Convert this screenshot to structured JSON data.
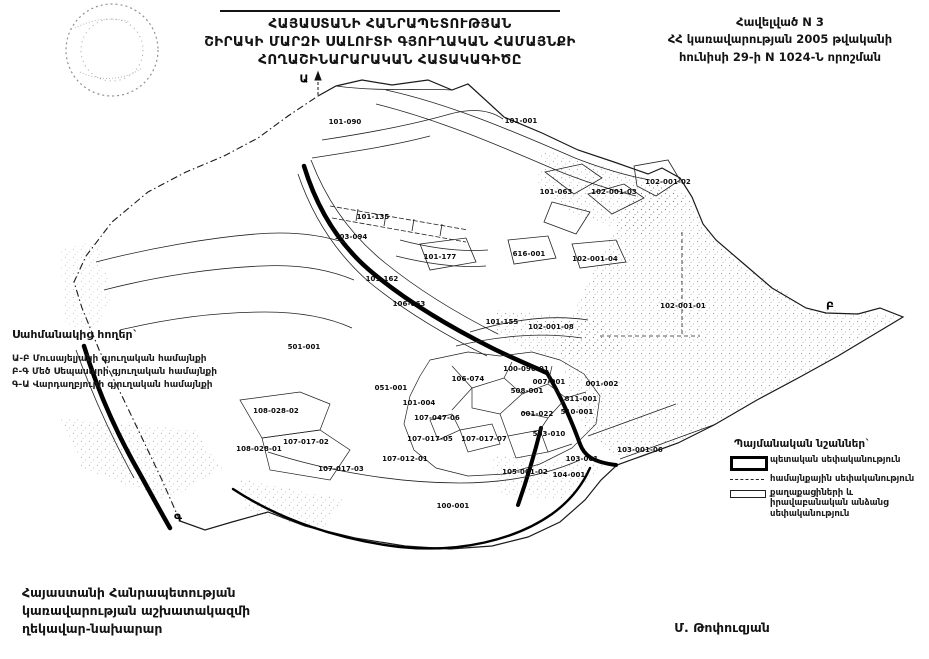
{
  "header": {
    "title_lines": [
      "ՀԱՅԱՍՏԱՆԻ ՀԱՆՐԱՊԵՏՈՒԹՅԱՆ",
      "ՇԻՐԱԿԻ ՄԱՐԶԻ ՍԱԼՈՒՏԻ ԳՅՈՒՂԱԿԱՆ ՀԱՄԱՅՆՔԻ",
      "ՀՈՂԱՇԻՆԱՐԱՐԱԿԱՆ ՀԱՏԱԿԱԳԻԾԸ"
    ],
    "annex_lines": [
      "Հավելված N 3",
      "ՀՀ կառավարության 2005 թվականի",
      "հունիսի 29-ի N 1024-Ն որոշման"
    ]
  },
  "adjacent_lands": {
    "title": "Սահմանակից հողեր`",
    "items": [
      "Ա-Բ Մուսայելյանի գյուղական համայնքի",
      "Բ-Գ Մեծ Սեպասարի գյուղական համայնքի",
      "Գ-Ա Վարդաղբյուրի գյուղական համայնքի"
    ]
  },
  "legend": {
    "title": "Պայմանական նշաններ`",
    "items": [
      {
        "symbol": "thick-border-rectangle",
        "label": "պետական սեփականություն"
      },
      {
        "symbol": "thin-dashed-line",
        "label": "համայնքային սեփականություն"
      },
      {
        "symbol": "double-line-rectangle",
        "label": "քաղաքացիների և իրավաբանական անձանց սեփականություն"
      }
    ]
  },
  "footer": {
    "left_lines": [
      "Հայաստանի Հանրապետության",
      "կառավարության աշխատակազմի",
      "ղեկավար-նախարար"
    ],
    "signature": "Մ. Թոփուզյան"
  },
  "map": {
    "boundary_points": [
      {
        "label": "Ա",
        "x": 304,
        "y": 79
      },
      {
        "label": "Բ",
        "x": 830,
        "y": 306
      },
      {
        "label": "Գ",
        "x": 178,
        "y": 518
      }
    ],
    "parcels": [
      {
        "id": "101-090",
        "x": 345,
        "y": 122
      },
      {
        "id": "101-001",
        "x": 521,
        "y": 121
      },
      {
        "id": "101-063",
        "x": 556,
        "y": 192
      },
      {
        "id": "102-001-03",
        "x": 614,
        "y": 192
      },
      {
        "id": "102-001-02",
        "x": 668,
        "y": 182
      },
      {
        "id": "616-001",
        "x": 529,
        "y": 254
      },
      {
        "id": "102-001-04",
        "x": 595,
        "y": 259
      },
      {
        "id": "102-001-01",
        "x": 683,
        "y": 306
      },
      {
        "id": "101-135",
        "x": 373,
        "y": 217
      },
      {
        "id": "103-094",
        "x": 351,
        "y": 237
      },
      {
        "id": "101-177",
        "x": 440,
        "y": 257
      },
      {
        "id": "101-162",
        "x": 382,
        "y": 279
      },
      {
        "id": "106-063",
        "x": 409,
        "y": 304
      },
      {
        "id": "101-155",
        "x": 502,
        "y": 322
      },
      {
        "id": "102-001-08",
        "x": 551,
        "y": 327
      },
      {
        "id": "501-001",
        "x": 304,
        "y": 347
      },
      {
        "id": "100-090-01",
        "x": 526,
        "y": 369
      },
      {
        "id": "106-074",
        "x": 468,
        "y": 379
      },
      {
        "id": "007-001",
        "x": 549,
        "y": 382
      },
      {
        "id": "001-002",
        "x": 602,
        "y": 384
      },
      {
        "id": "051-001",
        "x": 391,
        "y": 388
      },
      {
        "id": "508-001",
        "x": 527,
        "y": 391
      },
      {
        "id": "811-001",
        "x": 581,
        "y": 399
      },
      {
        "id": "101-004",
        "x": 419,
        "y": 403
      },
      {
        "id": "108-028-02",
        "x": 276,
        "y": 411
      },
      {
        "id": "001-022",
        "x": 537,
        "y": 414
      },
      {
        "id": "510-001",
        "x": 577,
        "y": 412
      },
      {
        "id": "107-047-06",
        "x": 437,
        "y": 418
      },
      {
        "id": "503-010",
        "x": 549,
        "y": 434
      },
      {
        "id": "107-017-05",
        "x": 430,
        "y": 439
      },
      {
        "id": "107-017-07",
        "x": 484,
        "y": 439
      },
      {
        "id": "107-017-02",
        "x": 306,
        "y": 442
      },
      {
        "id": "108-028-01",
        "x": 259,
        "y": 449
      },
      {
        "id": "103-001-06",
        "x": 640,
        "y": 450
      },
      {
        "id": "103-001",
        "x": 582,
        "y": 459
      },
      {
        "id": "107-012-01",
        "x": 405,
        "y": 459
      },
      {
        "id": "107-017-03",
        "x": 341,
        "y": 469
      },
      {
        "id": "105-001-02",
        "x": 525,
        "y": 472
      },
      {
        "id": "104-001",
        "x": 569,
        "y": 475
      },
      {
        "id": "100-001",
        "x": 453,
        "y": 506
      }
    ]
  }
}
